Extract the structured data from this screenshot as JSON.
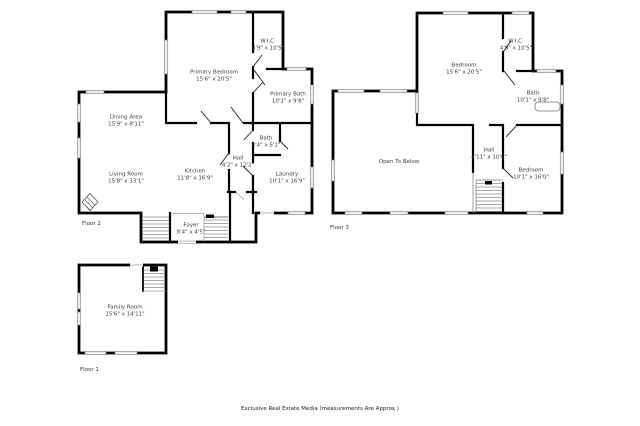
{
  "caption": "Exclusive Real Estate Media (measurements Are Approx.)",
  "colors": {
    "wall": "#000000",
    "window_fill": "#ededed",
    "window_edge": "#8d8d8d",
    "text": "#3d3d3d"
  },
  "floors": {
    "floor2": {
      "label": "Floor 2",
      "rooms": {
        "primary_bedroom": {
          "name": "Primary Bedroom",
          "dims": "15'6\" x 20'5\""
        },
        "wic": {
          "name": "W.I.C.",
          "dims": "4'9\" x 10'5\""
        },
        "primary_bath": {
          "name": "Primary Bath",
          "dims": "10'1\" x 9'8\""
        },
        "dining": {
          "name": "Dining Area",
          "dims": "15'9\" x 8'11\""
        },
        "living": {
          "name": "Living Room",
          "dims": "15'8\" x 13'1\""
        },
        "kitchen": {
          "name": "Kitchen",
          "dims": "11'8\" x 16'9\""
        },
        "hall": {
          "name": "Hall",
          "dims": "4'2\" x 12'2\""
        },
        "bath": {
          "name": "Bath",
          "dims": "4'4\" x 5'1\""
        },
        "laundry": {
          "name": "Laundry",
          "dims": "10'1\" x 16'9\""
        },
        "foyer": {
          "name": "Foyer",
          "dims": "8'4\" x 4'5\""
        }
      }
    },
    "floor3": {
      "label": "Floor 3",
      "rooms": {
        "bedroom_main": {
          "name": "Bedroom",
          "dims": "15'6\" x 20'5\""
        },
        "wic": {
          "name": "W.I.C.",
          "dims": "4'9\" x 10'5\""
        },
        "bath": {
          "name": "Bath",
          "dims": "10'1\" x 9'8\""
        },
        "open_below": {
          "name": "Open To Below",
          "dims": ""
        },
        "hall": {
          "name": "Hall",
          "dims": "4'11\" x 10'6\""
        },
        "bedroom2": {
          "name": "Bedroom",
          "dims": "10'1\" x 16'0\""
        }
      }
    },
    "floor1": {
      "label": "Floor 1",
      "rooms": {
        "family_room": {
          "name": "Family Room",
          "dims": "15'6\" x 14'11\""
        }
      }
    }
  }
}
